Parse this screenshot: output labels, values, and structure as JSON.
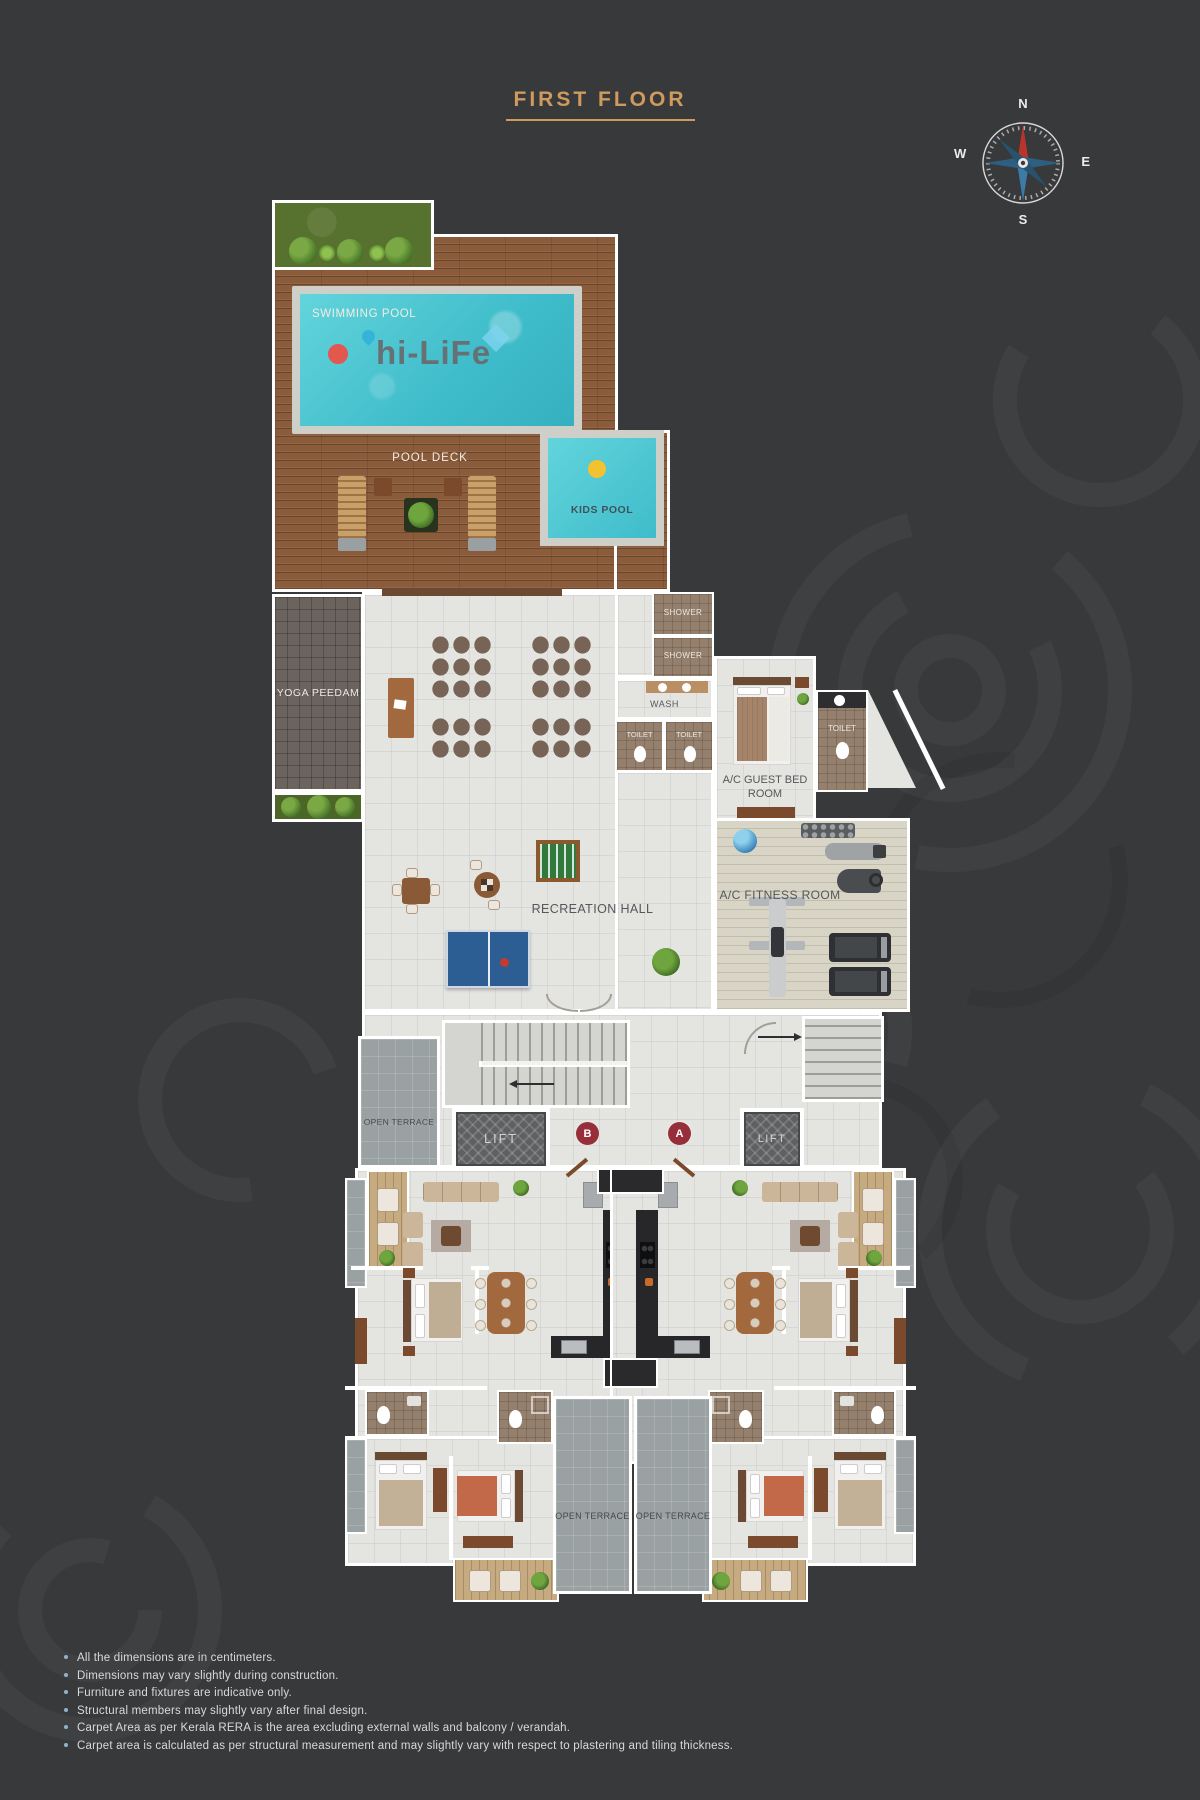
{
  "title": "FIRST FLOOR",
  "compass": {
    "north": "N",
    "east": "E",
    "south": "S",
    "west": "W"
  },
  "pool_area": {
    "swimming_pool_label": "SWIMMING POOL",
    "logo_text": "hi-LiFe",
    "pool_deck_label": "POOL DECK",
    "kids_pool_label": "KIDS POOL"
  },
  "amenities": {
    "yoga_label": "YOGA PEEDAM",
    "recreation_label": "RECREATION HALL",
    "fitness_label": "A/C FITNESS ROOM",
    "guest_bedroom_label": "A/C GUEST BED ROOM",
    "shower1_label": "SHOWER",
    "shower2_label": "SHOWER",
    "wash_label": "WASH",
    "toilet1_label": "TOILET",
    "toilet2_label": "TOILET",
    "guest_toilet_label": "TOILET"
  },
  "circulation": {
    "open_terrace_left_label": "OPEN TERRACE",
    "lift_left_label": "LIFT",
    "lift_right_label": "LIFT",
    "tower_b_label": "B",
    "tower_a_label": "A",
    "terrace_bottom_left_label": "OPEN TERRACE",
    "terrace_bottom_right_label": "OPEN TERRACE"
  },
  "footnotes": [
    "All the dimensions are in centimeters.",
    "Dimensions may vary slightly during construction.",
    "Furniture and fixtures are indicative only.",
    "Structural members may slightly vary after final design.",
    "Carpet Area as per Kerala RERA is the area excluding external walls and balcony / verandah.",
    "Carpet area is calculated as per structural measurement and may slightly vary with respect to plastering and tiling thickness."
  ],
  "colors": {
    "background": "#38393b",
    "accent_gold": "#cf9a5e",
    "pool_water": "#4cc8d2",
    "wood_deck": "#8a5c3c",
    "floor_tile": "#e4e5e1",
    "badge_red": "#962f3a",
    "lawn_green": "#57722f",
    "terrace_gray": "#9aa1a3"
  }
}
